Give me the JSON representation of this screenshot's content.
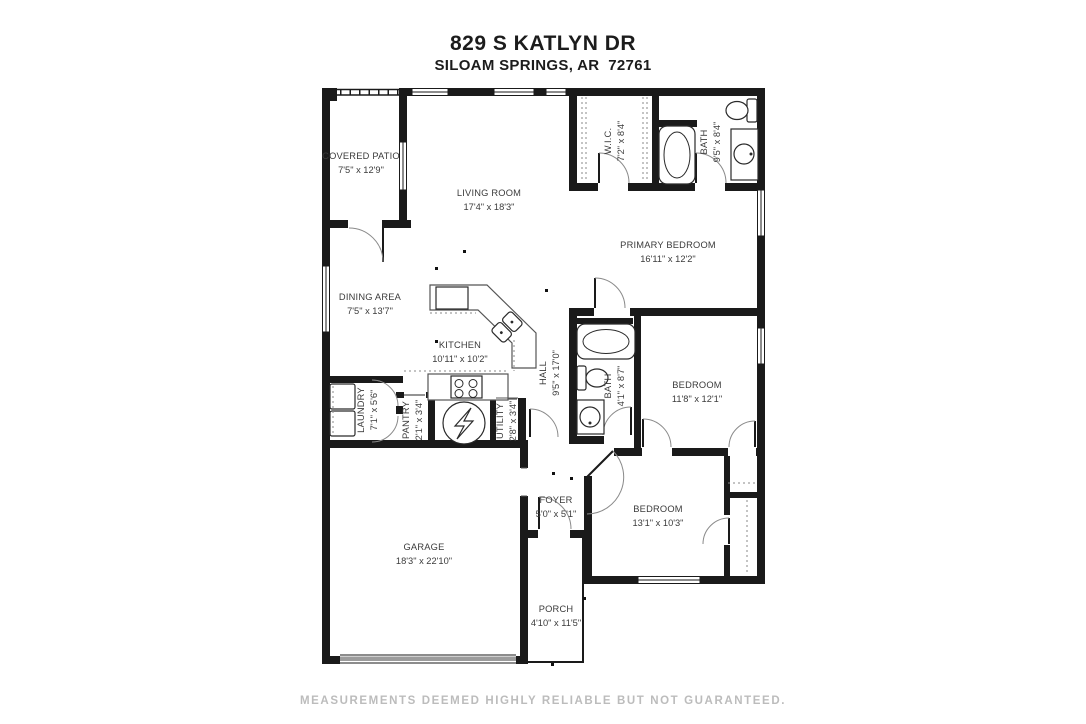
{
  "header": {
    "address_line1": "829 S KATLYN DR",
    "address_line2": "SILOAM SPRINGS, AR  72761"
  },
  "footer": {
    "disclaimer": "MEASUREMENTS DEEMED HIGHLY RELIABLE BUT NOT GUARANTEED."
  },
  "floorplan": {
    "rooms": [
      {
        "name": "COVERED PATIO",
        "dims": "7'5\" x 12'9\""
      },
      {
        "name": "LIVING ROOM",
        "dims": "17'4\" x 18'3\""
      },
      {
        "name": "W.I.C.",
        "dims": "7'2\" x 8'4\""
      },
      {
        "name": "BATH",
        "dims": "9'5\" x 8'4\""
      },
      {
        "name": "PRIMARY BEDROOM",
        "dims": "16'11\" x 12'2\""
      },
      {
        "name": "DINING AREA",
        "dims": "7'5\" x 13'7\""
      },
      {
        "name": "KITCHEN",
        "dims": "10'11\" x 10'2\""
      },
      {
        "name": "HALL",
        "dims": "9'5\" x 17'0\""
      },
      {
        "name": "BATH",
        "dims": "4'1\" x 8'7\""
      },
      {
        "name": "BEDROOM",
        "dims": "11'8\" x 12'1\""
      },
      {
        "name": "LAUNDRY",
        "dims": "7'1\" x 5'6\""
      },
      {
        "name": "PANTRY",
        "dims": "2'1\" x 3'4\""
      },
      {
        "name": "UTILITY",
        "dims": "2'8\" x 3'4\""
      },
      {
        "name": "FOYER",
        "dims": "5'0\" x 5'1\""
      },
      {
        "name": "BEDROOM",
        "dims": "13'1\" x 10'3\""
      },
      {
        "name": "GARAGE",
        "dims": "18'3\" x 22'10\""
      },
      {
        "name": "PORCH",
        "dims": "4'10\" x 11'5\""
      }
    ],
    "fixtures": [
      "bathtub-icon",
      "toilet-icon",
      "vanity-sink-icon",
      "washer-icon",
      "dryer-icon",
      "water-heater-icon",
      "stove-icon",
      "refrigerator-icon",
      "kitchen-sink-icon",
      "garage-door",
      "closet-rod",
      "closet-shelf",
      "door-arc",
      "window"
    ],
    "colors": {
      "walls": "#1a1a1a",
      "labels": "#3b3b3b",
      "disclaimer": "#bcbcbc",
      "garage_door": "#9c9c9c",
      "background": "#ffffff"
    }
  }
}
